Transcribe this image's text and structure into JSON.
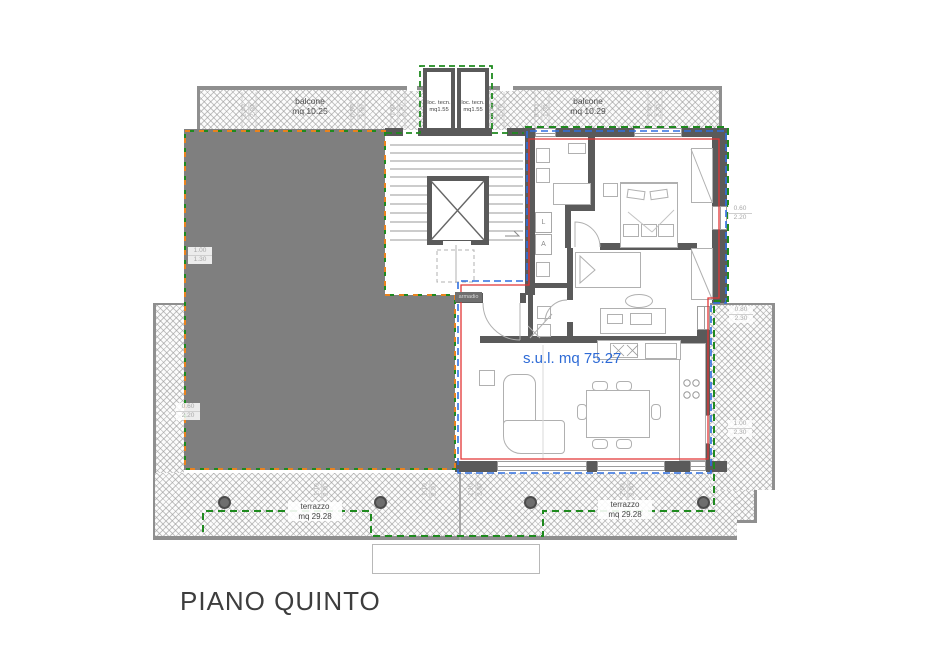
{
  "title": "PIANO QUINTO",
  "unit_area_label": "s.u.l. mq 75.27",
  "balconies": {
    "left": {
      "name": "balcone",
      "area": "mq 10.25"
    },
    "right": {
      "name": "balcone",
      "area": "mq 10.29"
    }
  },
  "tech_rooms": {
    "left": {
      "name": "loc. tecn.",
      "area": "mq1.55"
    },
    "right": {
      "name": "loc. tecn.",
      "area": "mq1.55"
    }
  },
  "terraces": {
    "left": {
      "name": "terrazzo",
      "area": "mq 29.28"
    },
    "right": {
      "name": "terrazzo",
      "area": "mq 29.28"
    }
  },
  "entry_closet_label": "armadio",
  "appliances": {
    "washer": "L",
    "dryer": "A"
  },
  "dims": {
    "top": [
      {
        "w": "1.40",
        "h": "2.30"
      },
      {
        "w": "0.50",
        "h": "1.80"
      },
      {
        "w": "0.60",
        "h": "1.30"
      },
      {
        "w": "0.60",
        "h": "1.70"
      },
      {
        "w": "0.50",
        "h": "1.30"
      },
      {
        "w": "1.40",
        "h": "2.30"
      }
    ],
    "left": [
      {
        "w": "1.00",
        "h": "1.30"
      },
      {
        "w": "0.60",
        "h": "2.20"
      }
    ],
    "right": [
      {
        "w": "0.60",
        "h": "2.20"
      },
      {
        "w": "0.80",
        "h": "2.30"
      },
      {
        "w": "1.00",
        "h": "2.30"
      }
    ],
    "bottom": [
      {
        "w": "1.10",
        "h": "2.30"
      },
      {
        "w": "1.10",
        "h": "2.30"
      },
      {
        "w": "1.10",
        "h": "2.30"
      },
      {
        "w": "2.50",
        "h": "2.30"
      }
    ]
  },
  "colors": {
    "unit_boundary_green": "#1f8a1f",
    "adjacent_unit_orange": "#e8821e",
    "perimeter_blue": "#2f6fe0",
    "interior_red": "#e23535",
    "area_text_blue": "#2e6bd6",
    "adjacent_fill_gray": "#7f7f7f"
  }
}
